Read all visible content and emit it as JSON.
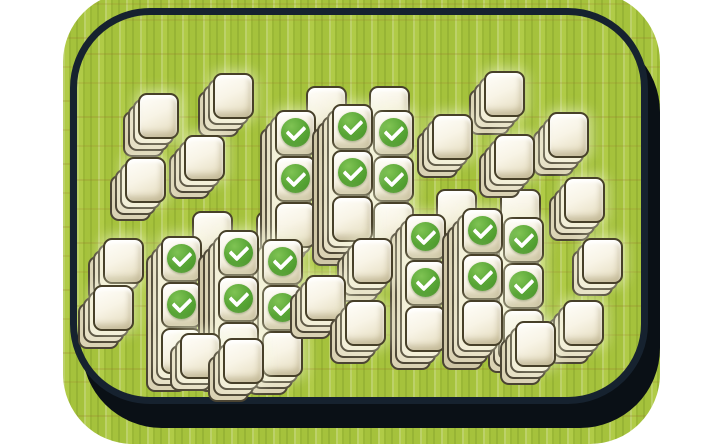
{
  "app": {
    "name": "mahjong-solitaire-board",
    "description": "Bamboo mat with mahjong tile stacks; matched tiles marked with green checkmarks"
  },
  "palette": {
    "page_background": "#ffffff",
    "bamboo_green": "#a5c23c",
    "bamboo_light_stripe": "#bad250",
    "bamboo_dark_stripe": "#8faf33",
    "bamboo_node_brown": "#967228",
    "border_navy": "#16222f",
    "shadow_black": "#0a1016",
    "tile_face_light": "#fffefa",
    "tile_face_dark": "#e0d8bb",
    "tile_outline": "#474029",
    "check_green": "#56a434",
    "check_mark": "#ffffff"
  },
  "tile_metrics": {
    "face_w": 41,
    "face_h": 46,
    "ridge_dx": -5,
    "ridge_dy": 6,
    "ridge_colors": [
      "#f2ecd7",
      "#e6dfc5",
      "#dad2b4",
      "#cfc6a6"
    ]
  },
  "counts": {
    "stacks": 34,
    "visible_tiles": 52,
    "checked_tiles": 18
  },
  "stacks": [
    {
      "id": "top-cluster-peek-left",
      "x": 306,
      "y": 86,
      "depth": 0,
      "faces": [
        false
      ]
    },
    {
      "id": "top-cluster-peek-right",
      "x": 369,
      "y": 86,
      "depth": 0,
      "faces": [
        false
      ]
    },
    {
      "id": "bl-cluster-peek-left",
      "x": 192,
      "y": 211,
      "depth": 0,
      "faces": [
        false
      ]
    },
    {
      "id": "bl-cluster-peek-right",
      "x": 256,
      "y": 211,
      "depth": 0,
      "faces": [
        false
      ]
    },
    {
      "id": "br-cluster-peek-left",
      "x": 436,
      "y": 189,
      "depth": 0,
      "faces": [
        false
      ]
    },
    {
      "id": "br-cluster-peek-right",
      "x": 500,
      "y": 189,
      "depth": 0,
      "faces": [
        false
      ]
    },
    {
      "id": "ne-chain-top",
      "x": 484,
      "y": 71,
      "depth": 3,
      "faces": [
        false
      ]
    },
    {
      "id": "nw-chain2-top",
      "x": 213,
      "y": 73,
      "depth": 3,
      "faces": [
        false
      ]
    },
    {
      "id": "nw-chain1-top",
      "x": 138,
      "y": 93,
      "depth": 3,
      "faces": [
        false
      ]
    },
    {
      "id": "top-cluster-left-col",
      "x": 275,
      "y": 110,
      "depth": 3,
      "faces": [
        true,
        true,
        false
      ]
    },
    {
      "id": "top-cluster-right-col",
      "x": 373,
      "y": 110,
      "depth": 3,
      "faces": [
        true,
        true,
        false
      ]
    },
    {
      "id": "top-cluster-center-col",
      "x": 332,
      "y": 104,
      "depth": 4,
      "faces": [
        true,
        true,
        false
      ]
    },
    {
      "id": "ne-chain-right",
      "x": 548,
      "y": 112,
      "depth": 3,
      "faces": [
        false
      ]
    },
    {
      "id": "ne-chain-left",
      "x": 432,
      "y": 114,
      "depth": 3,
      "faces": [
        false
      ]
    },
    {
      "id": "ne-chain-center",
      "x": 494,
      "y": 134,
      "depth": 3,
      "faces": [
        false
      ]
    },
    {
      "id": "nw-chain2-bottom",
      "x": 184,
      "y": 135,
      "depth": 3,
      "faces": [
        false
      ]
    },
    {
      "id": "nw-chain1-bottom",
      "x": 125,
      "y": 157,
      "depth": 3,
      "faces": [
        false
      ]
    },
    {
      "id": "ne-chain-lower",
      "x": 564,
      "y": 177,
      "depth": 3,
      "faces": [
        false
      ]
    },
    {
      "id": "br-cluster-left-col",
      "x": 405,
      "y": 214,
      "depth": 3,
      "faces": [
        true,
        true,
        false
      ]
    },
    {
      "id": "br-cluster-right-col",
      "x": 503,
      "y": 217,
      "depth": 3,
      "faces": [
        true,
        true,
        false
      ]
    },
    {
      "id": "br-cluster-center-col",
      "x": 462,
      "y": 208,
      "depth": 4,
      "faces": [
        true,
        true,
        false
      ]
    },
    {
      "id": "east-tail-top",
      "x": 582,
      "y": 238,
      "depth": 2,
      "faces": [
        false
      ]
    },
    {
      "id": "west-chain-top",
      "x": 103,
      "y": 238,
      "depth": 3,
      "faces": [
        false
      ]
    },
    {
      "id": "bl-cluster-left-col",
      "x": 161,
      "y": 236,
      "depth": 3,
      "faces": [
        true,
        true,
        false
      ]
    },
    {
      "id": "bl-cluster-right-col",
      "x": 262,
      "y": 239,
      "depth": 3,
      "faces": [
        true,
        true,
        false
      ]
    },
    {
      "id": "bl-cluster-center-col",
      "x": 218,
      "y": 230,
      "depth": 4,
      "faces": [
        true,
        true,
        false
      ]
    },
    {
      "id": "mid-tail-top",
      "x": 352,
      "y": 238,
      "depth": 3,
      "faces": [
        false
      ]
    },
    {
      "id": "mid-tail-left",
      "x": 305,
      "y": 275,
      "depth": 3,
      "faces": [
        false
      ]
    },
    {
      "id": "west-chain-bottom",
      "x": 93,
      "y": 285,
      "depth": 3,
      "faces": [
        false
      ]
    },
    {
      "id": "east-tail-middle",
      "x": 563,
      "y": 300,
      "depth": 3,
      "faces": [
        false
      ]
    },
    {
      "id": "mid-tail-bottom",
      "x": 345,
      "y": 300,
      "depth": 3,
      "faces": [
        false
      ]
    },
    {
      "id": "east-tail-bottom",
      "x": 515,
      "y": 321,
      "depth": 3,
      "faces": [
        false
      ]
    },
    {
      "id": "bl-tail-left",
      "x": 180,
      "y": 333,
      "depth": 2,
      "faces": [
        false
      ]
    },
    {
      "id": "bl-tail-right",
      "x": 223,
      "y": 338,
      "depth": 3,
      "faces": [
        false
      ]
    }
  ]
}
